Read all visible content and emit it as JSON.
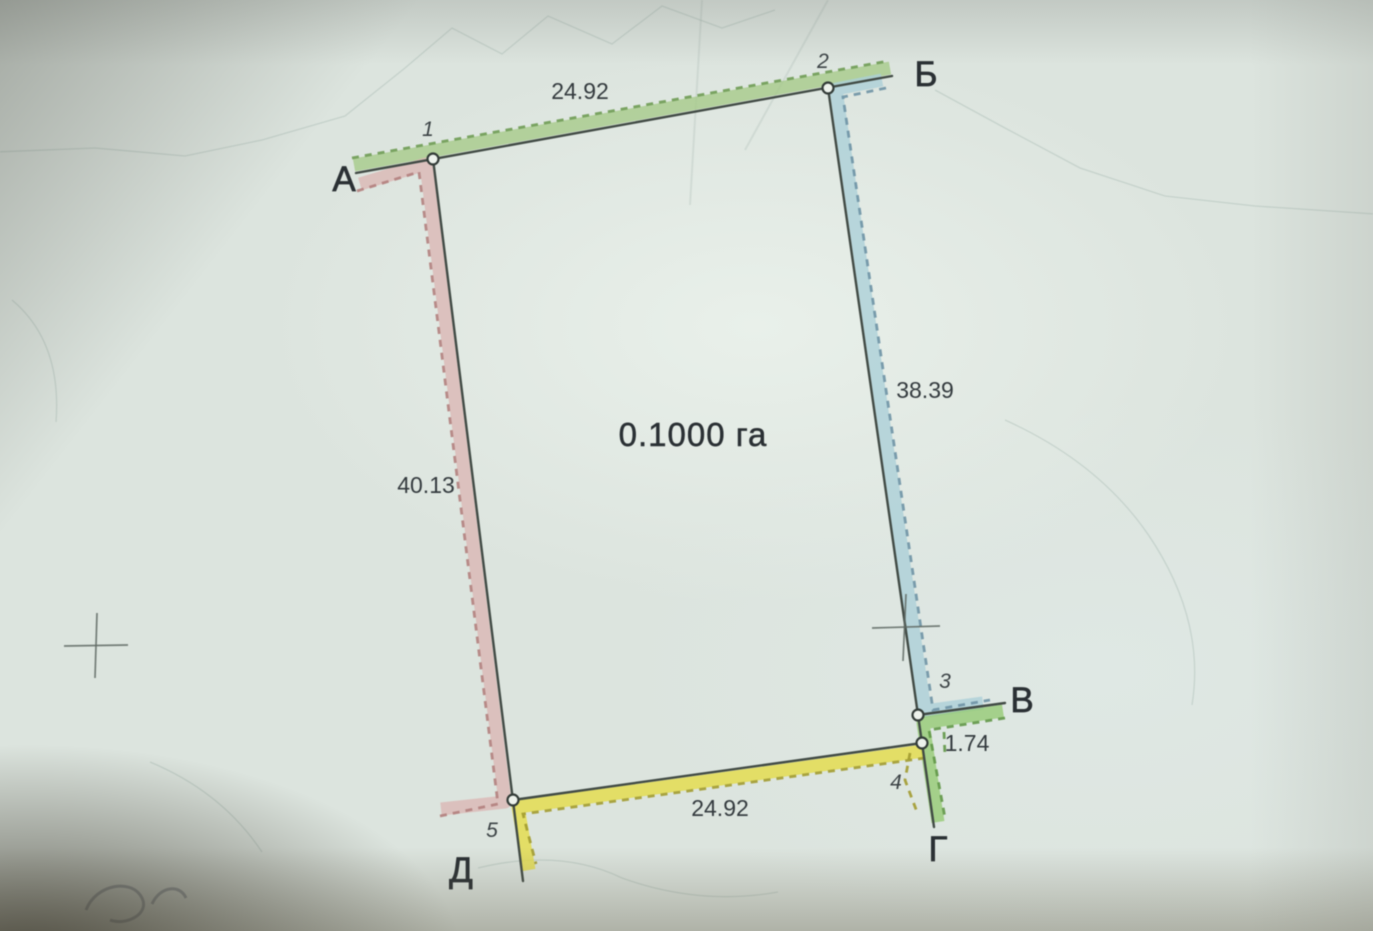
{
  "plan": {
    "area_label": "0.1000 га",
    "vertices": [
      {
        "label": "А",
        "point_number": "1"
      },
      {
        "label": "Б",
        "point_number": "2"
      },
      {
        "label": "В",
        "point_number": "3"
      },
      {
        "label": "Г",
        "point_number": "4"
      },
      {
        "label": "Д",
        "point_number": "5"
      }
    ],
    "sides": [
      {
        "from": "А",
        "to": "Б",
        "length": "24.92",
        "band_color": "#a4cb85",
        "dash_color": "#6d9c51"
      },
      {
        "from": "Б",
        "to": "В",
        "length": "38.39",
        "band_color": "#a9cfd8",
        "dash_color": "#6d93a6"
      },
      {
        "from": "В",
        "to": "Г",
        "length": "1.74",
        "band_color": "#92cb6e",
        "dash_color": "#5f9845"
      },
      {
        "from": "Г",
        "to": "Д",
        "length": "24.92",
        "band_color": "#e6dd3c",
        "dash_color": "#a39c2b"
      },
      {
        "from": "Д",
        "to": "А",
        "length": "40.13",
        "band_color": "#ddb6b3",
        "dash_color": "#b5807d"
      }
    ]
  }
}
